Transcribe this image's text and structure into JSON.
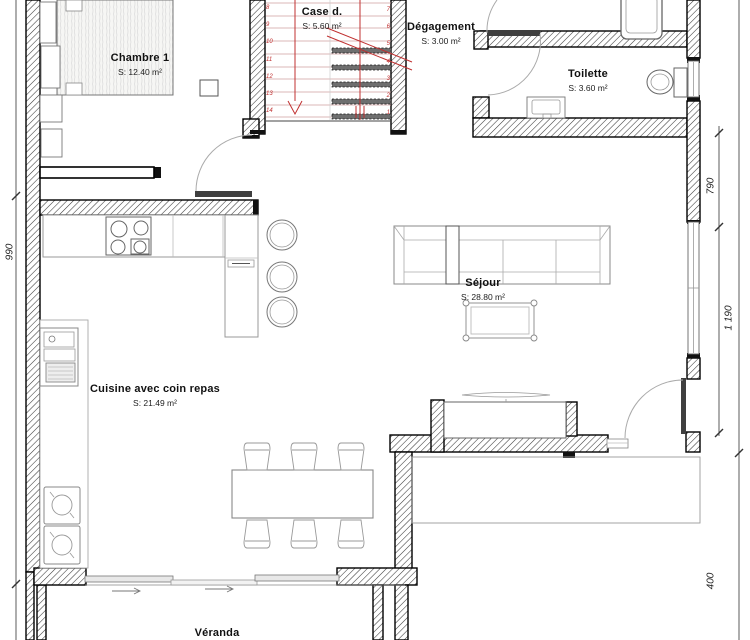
{
  "rooms": {
    "chambre1": {
      "name": "Chambre 1",
      "area": "S: 12.40 m²"
    },
    "case_desc": {
      "name": "Case d.",
      "area": "S: 5.60 m²"
    },
    "degagement": {
      "name": "Dégagement",
      "area": "S: 3.00 m²"
    },
    "toilette": {
      "name": "Toilette",
      "area": "S: 3.60 m²"
    },
    "sejour": {
      "name": "Séjour",
      "area": "S: 28.80 m²"
    },
    "cuisine": {
      "name": "Cuisine avec coin repas",
      "area": "S: 21.49 m²"
    },
    "veranda": {
      "name": "Véranda"
    }
  },
  "dimensions": {
    "left": "990",
    "right_top": "790",
    "right_middle": "1 190",
    "right_bottom": "400"
  },
  "staircase": {
    "left_numbers": [
      "8",
      "9",
      "10",
      "11",
      "12",
      "13",
      "14"
    ],
    "right_numbers": [
      "7",
      "6",
      "5",
      "4",
      "3",
      "2",
      "1"
    ]
  },
  "colors": {
    "stair_annotation": "#c03030",
    "wall_line": "#000000",
    "furniture_line": "#888888"
  }
}
